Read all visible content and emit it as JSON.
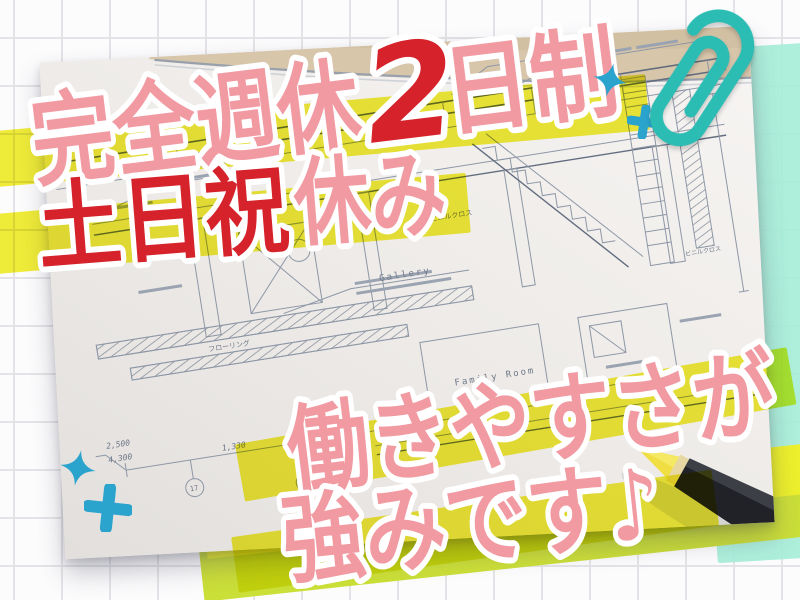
{
  "poster": {
    "description": "Recruitment ad over a photo of architectural blueprints",
    "headlines": {
      "line1": {
        "part1": "完全週休",
        "part2": "2",
        "part3": "日制"
      },
      "line2": {
        "part1": "土日祝",
        "part2": "休み"
      },
      "line3": {
        "text": "働きやすさが"
      },
      "line4": {
        "text": "強みです♪"
      }
    }
  },
  "photo": {
    "labels": {
      "gallery": "Gallery",
      "family_room": "Family Room"
    },
    "dims": {
      "d1": "2,500",
      "d2": "4,300",
      "d3": "1,330"
    },
    "refs": {
      "r1": "17",
      "r2": "14"
    },
    "annotations": {
      "a1": "ビニルクロス",
      "a2": "フローリング",
      "a3": "ビニルクロス"
    }
  },
  "colors": {
    "pink": "#F29AA2",
    "red": "#D6232B",
    "highlight_yellow": "#F2EE2E",
    "band_olive": "#CBDF39",
    "band_bright": "#EDF02C",
    "mint": "#A8EED8",
    "paperclip_teal": "#2BBCB4",
    "sparkle_blue": "#2AA3CD",
    "pencil_black": "#212227",
    "pencil_wood": "#C08C3F",
    "pencil_tip_yellow": "#F0DE42"
  },
  "icons": {
    "paperclip": "paperclip-icon",
    "sparkle_star": "sparkle-four-point-icon",
    "sparkle_plus": "sparkle-plus-icon",
    "pencil": "pencil-icon",
    "music_note": "included-in-line4-text"
  }
}
